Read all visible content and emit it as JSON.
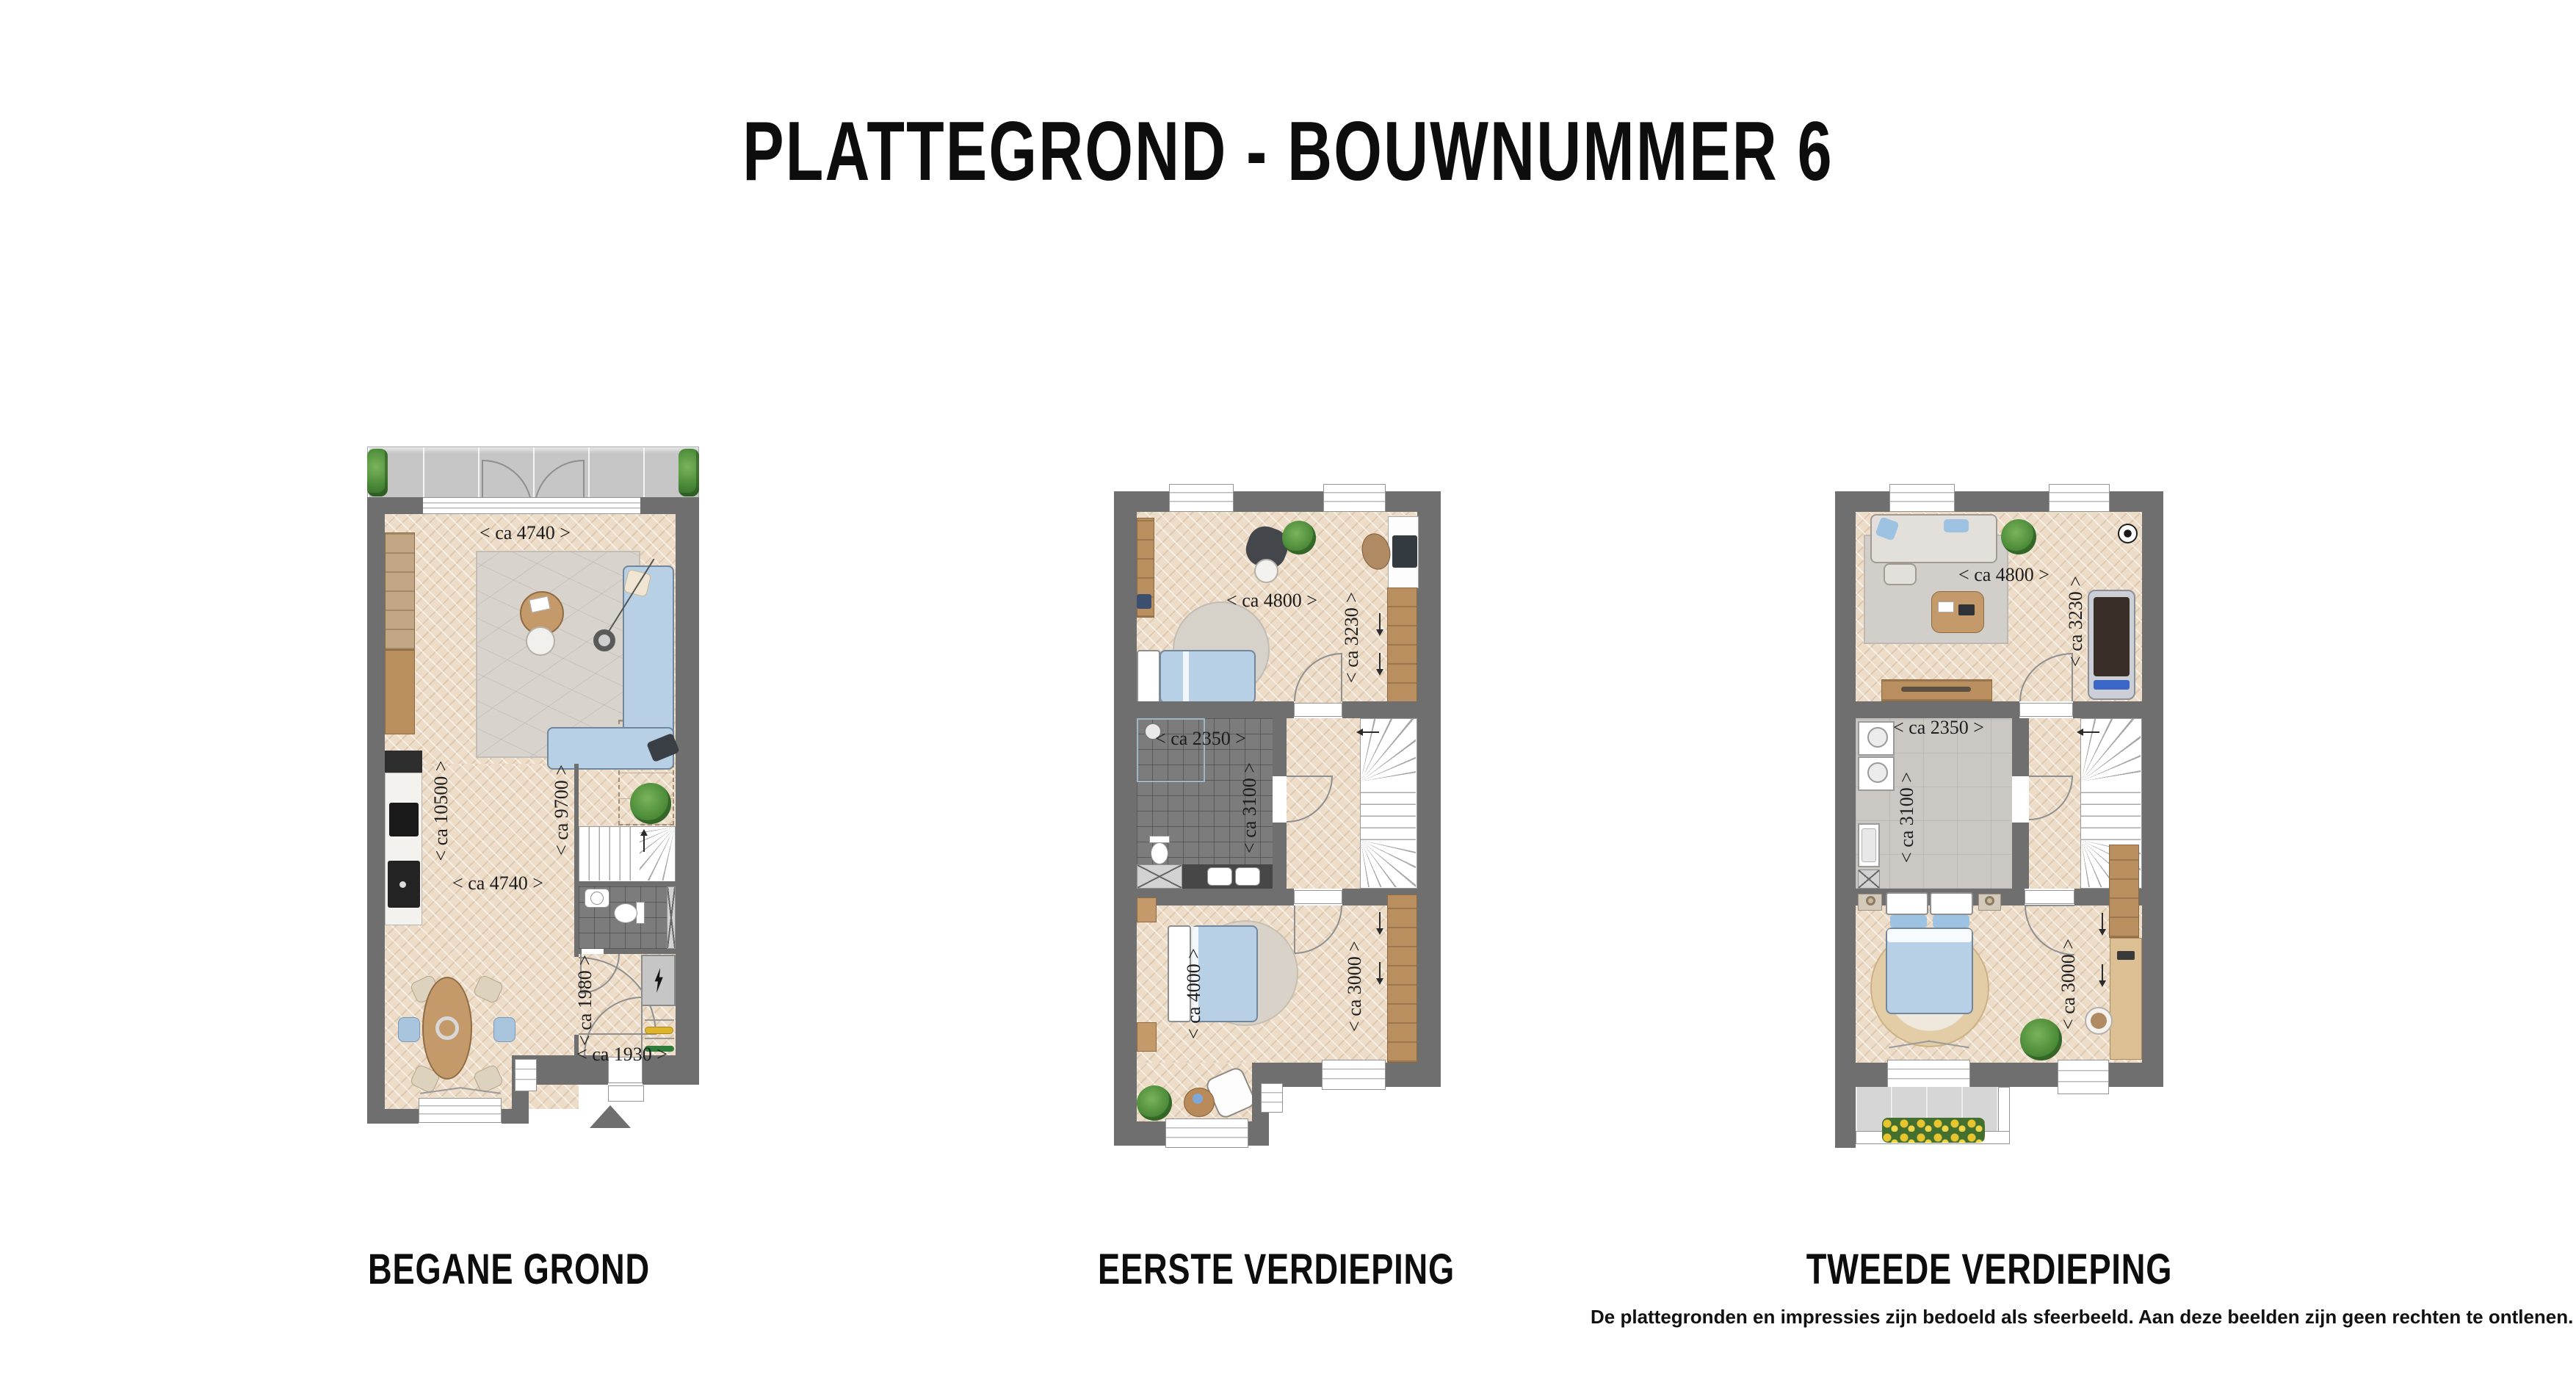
{
  "title": "PLATTEGROND - BOUWNUMMER 6",
  "disclaimer": "De plattegronden en impressies zijn bedoeld als sfeerbeeld. Aan deze beelden zijn geen rechten te ontlenen.",
  "floors": [
    {
      "id": "begane-grond",
      "label": "BEGANE GROND",
      "dims": {
        "width_top": "< ca 4740 >",
        "depth_left": "< ca 10500 >",
        "depth_mid": "< ca 9700 >",
        "width_mid": "< ca 4740 >",
        "hall_depth": "< ca 1980 >",
        "hall_width": "< ca 1930 >"
      }
    },
    {
      "id": "eerste-verdieping",
      "label": "EERSTE VERDIEPING",
      "dims": {
        "width_top": "< ca 4800 >",
        "depth_right": "< ca 3230 >",
        "bath_width": "< ca 2350 >",
        "bath_depth": "< ca 3100 >",
        "bed_depth": "< ca 4000 >",
        "landing_depth": "< ca 3000 >"
      }
    },
    {
      "id": "tweede-verdieping",
      "label": "TWEEDE VERDIEPING",
      "dims": {
        "width_top": "< ca 4800 >",
        "depth_right": "< ca 3230 >",
        "laundry_width": "< ca 2350 >",
        "laundry_depth": "< ca 3100 >",
        "landing_depth": "< ca 3000 >"
      }
    }
  ],
  "colors": {
    "wall": "#6f6f6f",
    "wood_floor": "#ecdcc8",
    "tile_dark": "#7c7c7c",
    "terrace": "#c6c6c6",
    "hedge": "#4b8a38",
    "furniture_blue": "#b7d0e6",
    "sofa_gray": "#e3dfda",
    "wood_furniture": "#b98f5f",
    "rug_gray": "#d8d4cd",
    "rug_jute": "#e2cda6",
    "meter_closet": "#c6c6c6",
    "flowers": "#e6c02e",
    "treadmill_belt": "#3b2f2b",
    "display_blue": "#3c66c4"
  }
}
